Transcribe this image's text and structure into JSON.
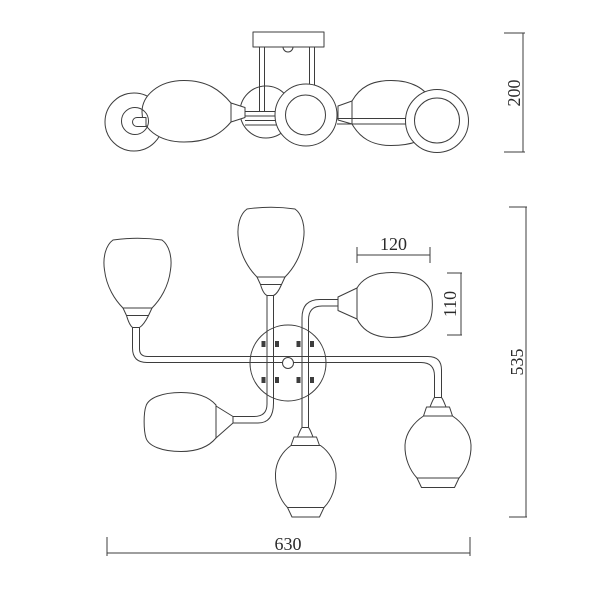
{
  "drawing": {
    "kind": "technical-dimension-drawing",
    "subject": "six-arm ceiling chandelier",
    "background_color": "#ffffff",
    "line_color": "#3d3d3d",
    "text_color": "#2b2b2b"
  },
  "views": {
    "side_view": {
      "id": "side-elevation"
    },
    "plan_view": {
      "id": "plan-view"
    }
  },
  "dimensions": {
    "overall_height": {
      "value": "200",
      "view": "side",
      "orientation": "vertical"
    },
    "shade_width": {
      "value": "120",
      "view": "plan",
      "orientation": "horizontal"
    },
    "shade_length": {
      "value": "110",
      "view": "plan",
      "orientation": "vertical"
    },
    "overall_depth": {
      "value": "535",
      "view": "plan",
      "orientation": "vertical"
    },
    "overall_width": {
      "value": "630",
      "view": "plan",
      "orientation": "horizontal"
    }
  }
}
